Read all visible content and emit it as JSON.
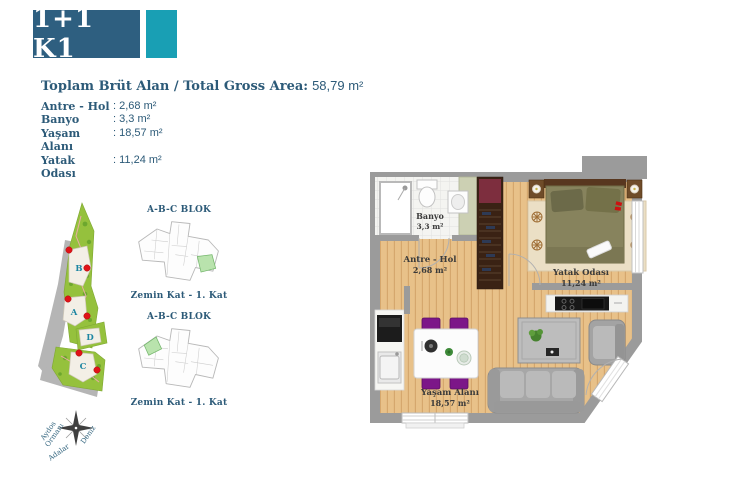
{
  "title_badge": {
    "label": "1+1 K1"
  },
  "summary": {
    "heading": "Toplam Brüt Alan / Total Gross Area:",
    "total_area": "58,79 m²"
  },
  "rooms": [
    {
      "label": "Antre - Hol",
      "value": ": 2,68 m²"
    },
    {
      "label": "Banyo",
      "value": ": 3,3 m²"
    },
    {
      "label": "Yaşam Alanı",
      "value": ": 18,57 m²"
    },
    {
      "label": "Yatak Odası",
      "value": ": 11,24 m²"
    }
  ],
  "site_plan": {
    "letters": {
      "a": "A",
      "b": "B",
      "c": "C",
      "d": "D"
    },
    "compass": {
      "aydos1": "Aydos",
      "aydos2": "Ormanı",
      "deniz": "Deniz",
      "adalar": "Adalar"
    }
  },
  "block_diagrams": [
    {
      "title": "A-B-C BLOK",
      "caption": "Zemin Kat - 1. Kat"
    },
    {
      "title": "A-B-C BLOK",
      "caption": "Zemin Kat - 1. Kat"
    }
  ],
  "floor_plan": {
    "banyo": {
      "name": "Banyo",
      "area": "3,3 m²"
    },
    "antre": {
      "name": "Antre - Hol",
      "area": "2,68 m²"
    },
    "yatak": {
      "name": "Yatak Odası",
      "area": "11,24 m²"
    },
    "yasam": {
      "name": "Yaşam Alanı",
      "area": "18,57 m²"
    }
  },
  "colors": {
    "navy": "#2e5f80",
    "teal": "#199fb4",
    "text_blue": "#2c5a78",
    "site_green": "#95c13d",
    "unit_green": "#b9e3ad",
    "marker_red": "#e01318",
    "wall_gray": "#9b9b9b",
    "wood": "#e8c189",
    "chair_purple": "#7c1688"
  }
}
